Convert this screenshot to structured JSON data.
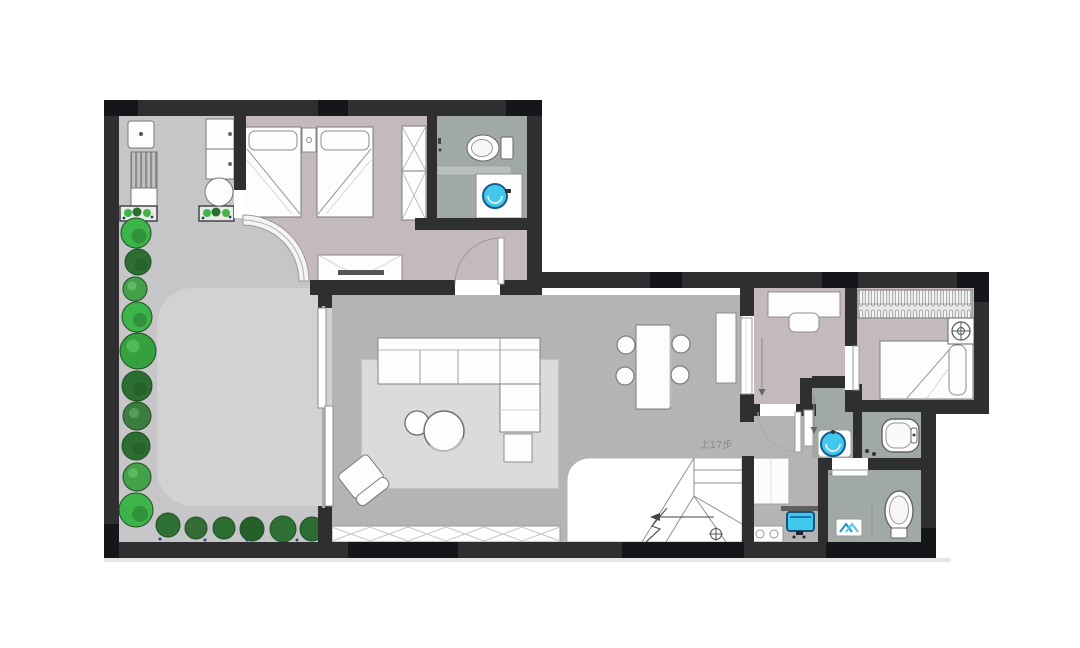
{
  "canvas": {
    "width": 1080,
    "height": 648,
    "background_color": "#ffffff"
  },
  "plan": {
    "kind": "residential floor plan (top-down)",
    "stair_annotation": "上17步"
  },
  "palette": {
    "wall": "#2f2f31",
    "wall_pillar": "#15161a",
    "terrace_floor": "#c6c6c8",
    "garden_path": "#d2d2d4",
    "living_floor": "#b4b4b6",
    "bedroom_floor": "#c4b9bc",
    "bathroom_floor": "#a0a9a4",
    "rug": "#dbdbdd",
    "furniture_white": "#fdfdfd",
    "furniture_outline": "#7a7a7a",
    "fixture_blue": "#41c8ec",
    "fixture_blue_outline": "#155d8d",
    "plant_green_bright": "#3db449",
    "plant_green_dark": "#2c6e31"
  },
  "rooms": [
    "garden-terrace",
    "bedroom-1",
    "ensuite-bathroom",
    "living-room",
    "dining-area",
    "study",
    "bedroom-2",
    "shower-room",
    "bathtub-room",
    "guest-bathroom",
    "laundry-hall",
    "staircase"
  ],
  "fixtures_and_furniture": [
    "twin-bed x2",
    "nightstand",
    "curved-sliding-door",
    "x-wardrobe",
    "toilet x2",
    "shower-basin-round",
    "vanity-basin-round",
    "laundry-sink-blue",
    "bathtub",
    "sectional-sofa",
    "round-coffee-table x2",
    "accent-chair",
    "dining-table",
    "dining-chair x4",
    "tv-console x2",
    "desk",
    "desk-chair",
    "double-bed",
    "hanging-clothes-wardrobe",
    "exhaust-fan-symbol",
    "floor-drain-symbol",
    "window-seat",
    "sliding-glass-door",
    "lounge-chair",
    "outdoor-sink",
    "dresser",
    "round-stool",
    "planter-box x2",
    "hall-cabinet",
    "counter-two-basins"
  ],
  "garden": {
    "left_row_plants": 10,
    "bottom_row_plants": 6,
    "planter_boxes": 2
  }
}
